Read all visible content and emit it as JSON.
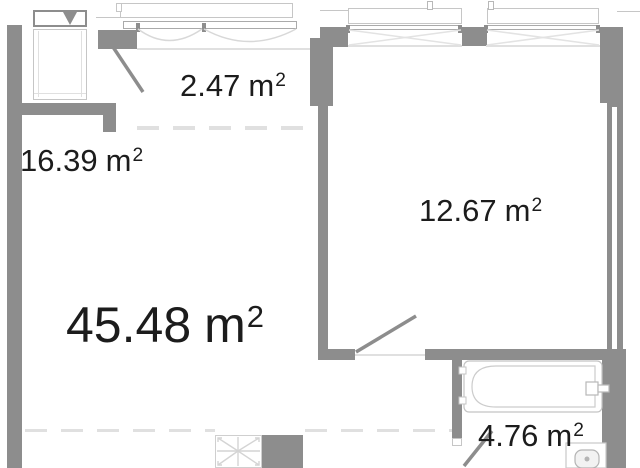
{
  "document": {
    "type": "apartment-floor-plan"
  },
  "units": {
    "base": "m",
    "sup": "2"
  },
  "areas": {
    "total": {
      "value": "45.48"
    },
    "living": {
      "value": "16.39"
    },
    "loggia": {
      "value": "2.47"
    },
    "bedroom": {
      "value": "12.67"
    },
    "bathroom": {
      "value": "4.76"
    }
  },
  "symbols": [
    "ventilation-triangle",
    "ventilation-shaft-cross",
    "door-swing",
    "window-opening",
    "bathtub",
    "sink"
  ],
  "colors": {
    "wall": "#8d8d8d",
    "fixture": "#c6c6c6",
    "faint": "#e0e0e0",
    "text": "#1c1c1c",
    "bg": "#ffffff"
  }
}
